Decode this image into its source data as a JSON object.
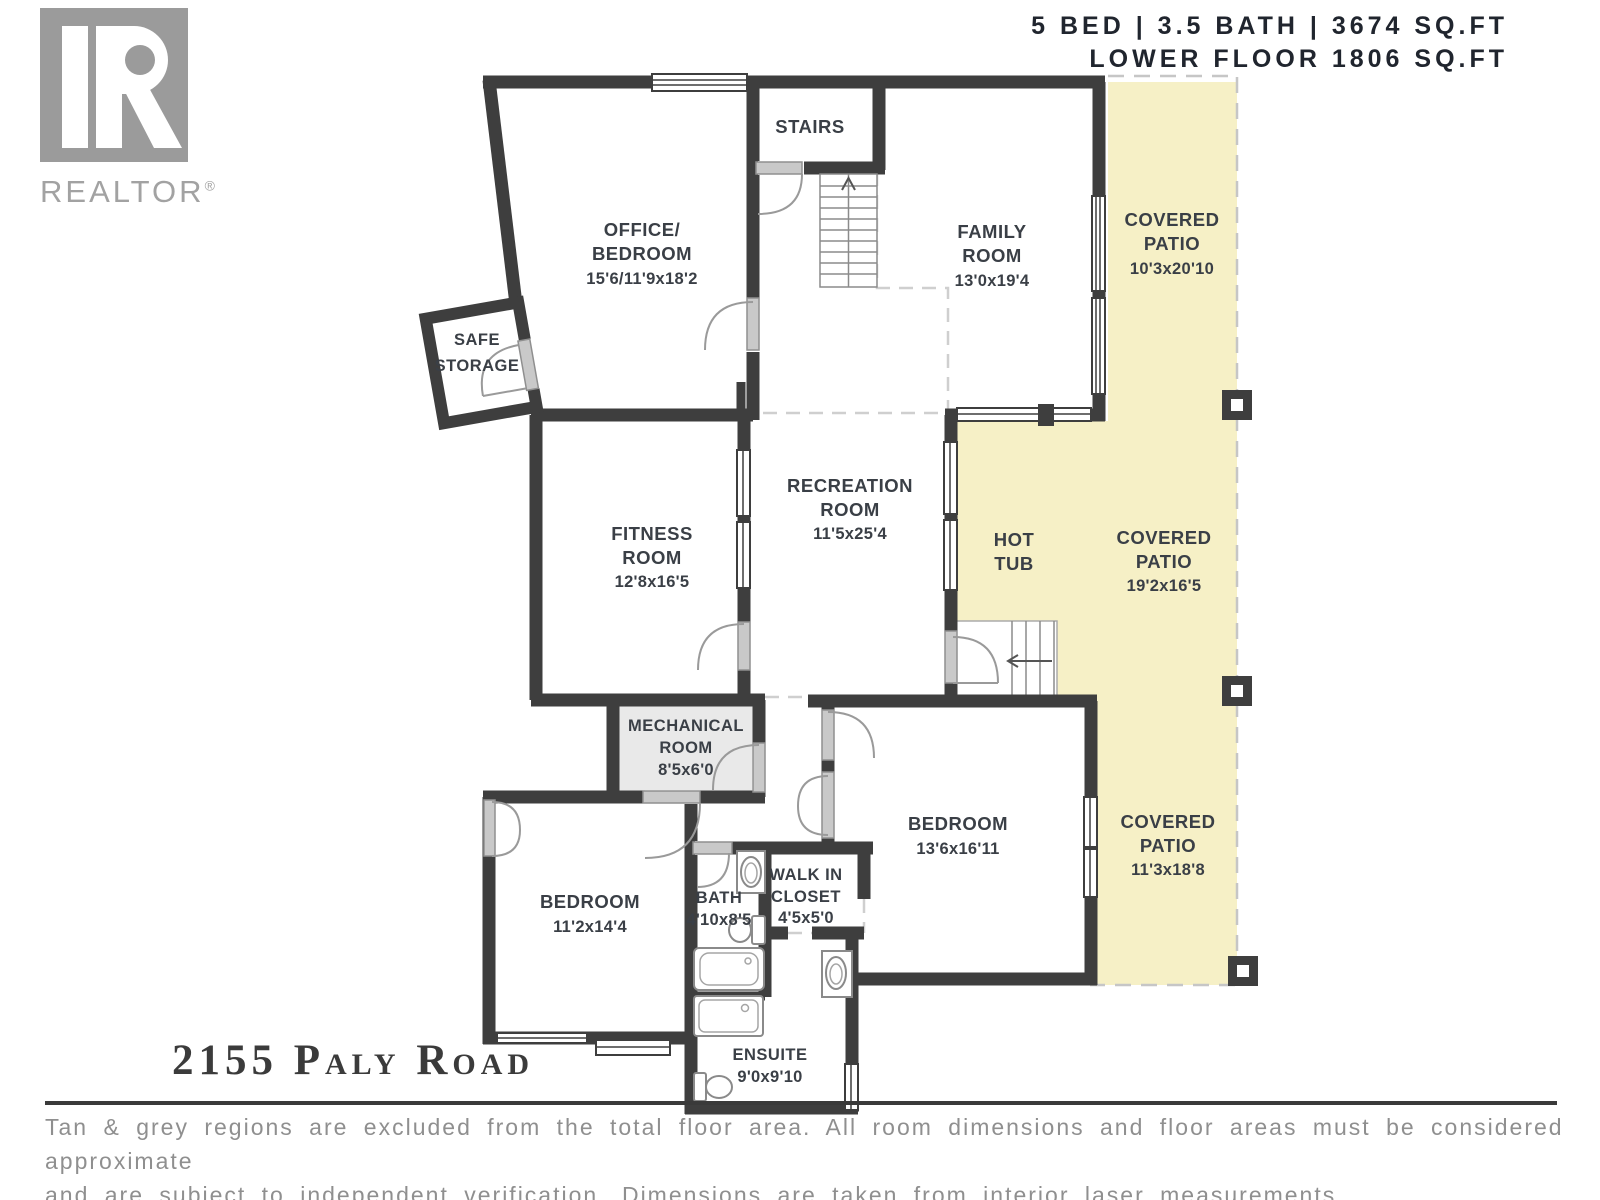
{
  "header": {
    "line1": "5 BED | 3.5 BATH | 3674 SQ.FT",
    "line2": "LOWER FLOOR 1806 SQ.FT"
  },
  "logo": {
    "brand": "REALTOR",
    "registered": "®"
  },
  "address": "2155 Paly Road",
  "disclaimer": {
    "line1": "Tan & grey regions are excluded from the total floor area. All room dimensions and floor areas must be considered approximate",
    "line2": "and are subject to independent verification. Dimensions are taken from interior laser measurements."
  },
  "colors": {
    "wall": "#3e3e3e",
    "patio_fill": "#f6f0c6",
    "mechanical_fill": "#e9e9e9",
    "door_panel": "#c9c9c9",
    "label_text": "#3a3f46",
    "header_text": "#20252e",
    "logo_grey": "#9b9b9b",
    "disclaimer_text": "#8f8f8f"
  },
  "rooms": {
    "stairs": {
      "line1": "STAIRS"
    },
    "office": {
      "line1": "OFFICE/",
      "line2": "BEDROOM",
      "dims": "15'6/11'9x18'2"
    },
    "safe_storage": {
      "line1": "SAFE",
      "line2": "STORAGE"
    },
    "family": {
      "line1": "FAMILY",
      "line2": "ROOM",
      "dims": "13'0x19'4"
    },
    "covered_patio_upper": {
      "line1": "COVERED",
      "line2": "PATIO",
      "dims": "10'3x20'10"
    },
    "recreation": {
      "line1": "RECREATION",
      "line2": "ROOM",
      "dims": "11'5x25'4"
    },
    "fitness": {
      "line1": "FITNESS",
      "line2": "ROOM",
      "dims": "12'8x16'5"
    },
    "hot_tub": {
      "line1": "HOT",
      "line2": "TUB"
    },
    "covered_patio_middle": {
      "line1": "COVERED",
      "line2": "PATIO",
      "dims": "19'2x16'5"
    },
    "mechanical": {
      "line1": "MECHANICAL",
      "line2": "ROOM",
      "dims": "8'5x6'0"
    },
    "bedroom_right": {
      "line1": "BEDROOM",
      "dims": "13'6x16'11"
    },
    "covered_patio_lower": {
      "line1": "COVERED",
      "line2": "PATIO",
      "dims": "11'3x18'8"
    },
    "bedroom_left": {
      "line1": "BEDROOM",
      "dims": "11'2x14'4"
    },
    "bath": {
      "line1": "BATH",
      "dims": "4'10x8'5"
    },
    "walk_in_closet": {
      "line1": "WALK IN",
      "line2": "CLOSET",
      "dims": "4'5x5'0"
    },
    "ensuite": {
      "line1": "ENSUITE",
      "dims": "9'0x9'10"
    }
  }
}
